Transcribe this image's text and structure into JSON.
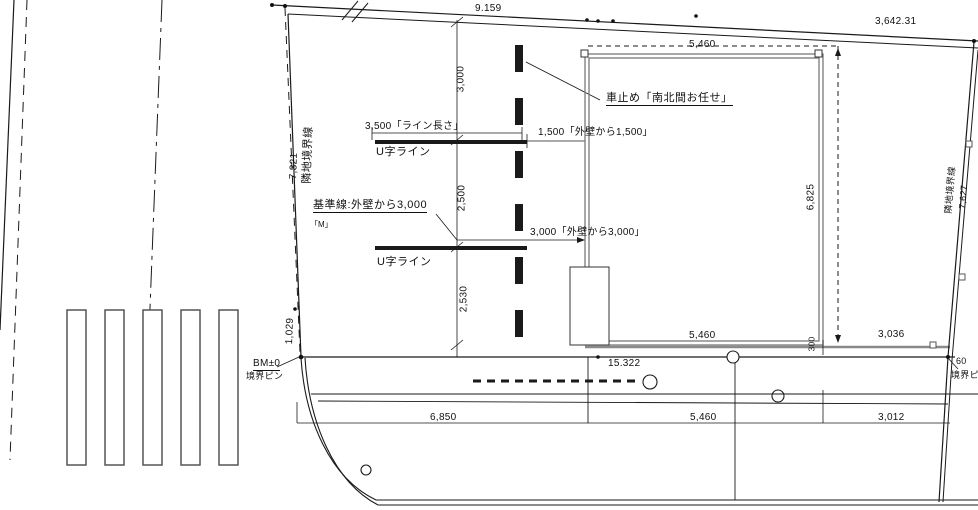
{
  "site_plan": {
    "top_boundary": {
      "dim_left": "9.159",
      "dim_right": "3,642.31"
    },
    "left_boundary": {
      "label": "隣地境界線",
      "dim_upper": "7,321",
      "dim_lower": "1,029"
    },
    "right_boundary": {
      "label": "隣地境界線",
      "dim": "7,627",
      "offset_dim": "60",
      "pin_label": "境界ピン"
    },
    "benchmark": {
      "label": "BM±0",
      "pin_label": "境界ピン"
    },
    "building": {
      "width_top": "5,460",
      "width_bottom": "5,460",
      "height": "6,825",
      "offset_right": "3,036",
      "offset_south": "300"
    },
    "annotations": {
      "car_stop": "車止め「南北間お任せ」",
      "line_length": "3,500「ライン長さ」",
      "from_wall_1500": "1,500「外壁から1,500」",
      "u_line_1": "U字ライン",
      "u_line_2": "U字ライン",
      "base_line": "基準線:外壁から3,000",
      "marker_m": "「M」",
      "from_wall_3000": "3,000「外壁から3,000」"
    },
    "vertical_dims": {
      "top": "3,000",
      "middle": "2,500",
      "bottom": "2,530"
    },
    "south_dims": {
      "total": "15.322",
      "row": [
        "6,850",
        "5,460",
        "3,012"
      ]
    }
  },
  "colors": {
    "line": "#1a1a1a",
    "wall": "#7a7a7a",
    "background": "#ffffff"
  }
}
